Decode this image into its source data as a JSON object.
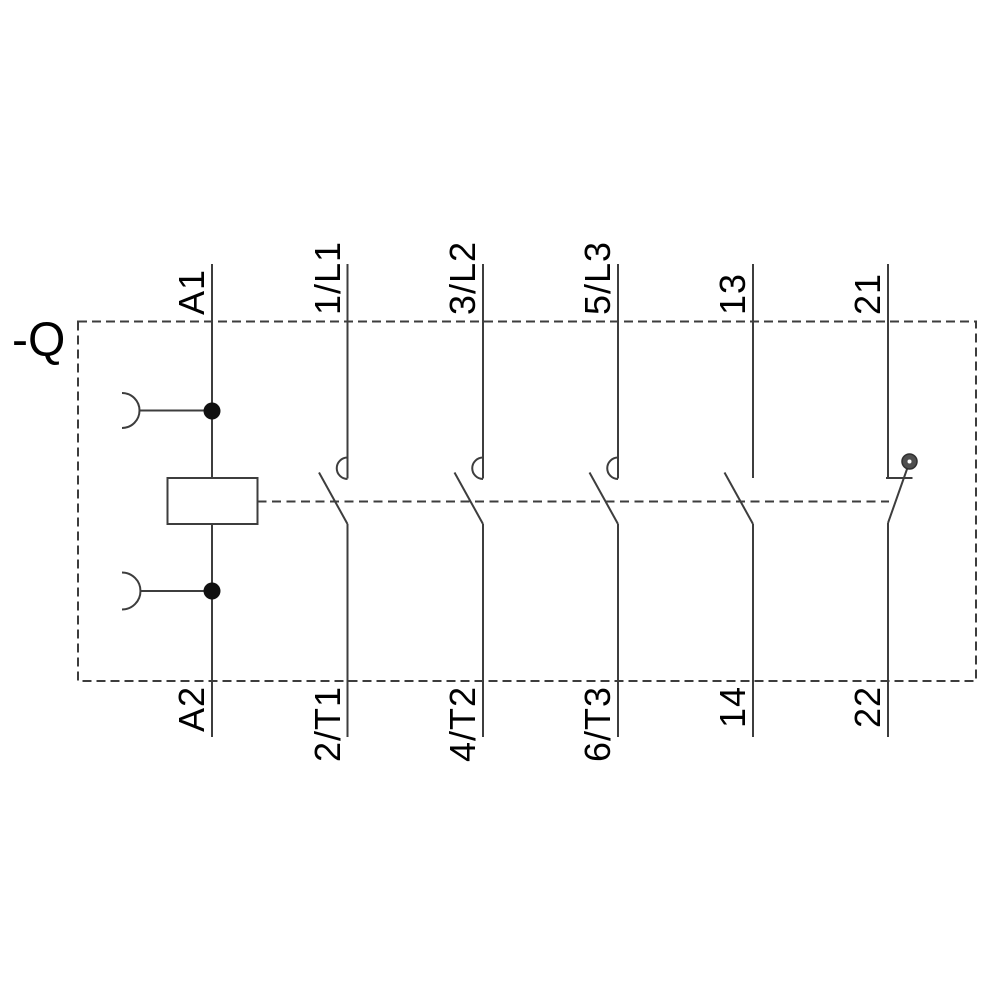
{
  "device_tag": "-Q",
  "schematic": {
    "kind": "contactor-wiring-diagram",
    "columns": [
      {
        "role": "coil",
        "top": "A1",
        "bottom": "A2"
      },
      {
        "role": "main-pole-1",
        "top": "1/L1",
        "bottom": "2/T1"
      },
      {
        "role": "main-pole-2",
        "top": "3/L2",
        "bottom": "4/T2"
      },
      {
        "role": "main-pole-3",
        "top": "5/L3",
        "bottom": "6/T3"
      },
      {
        "role": "aux-no",
        "top": "13",
        "bottom": "14"
      },
      {
        "role": "aux-nc",
        "top": "21",
        "bottom": "22"
      }
    ]
  },
  "colors": {
    "line": "#3d3d3d",
    "text": "#000000",
    "background": "#ffffff",
    "junction_dot": "#111111",
    "nc_pivot_dot": "#4f4f4f"
  }
}
